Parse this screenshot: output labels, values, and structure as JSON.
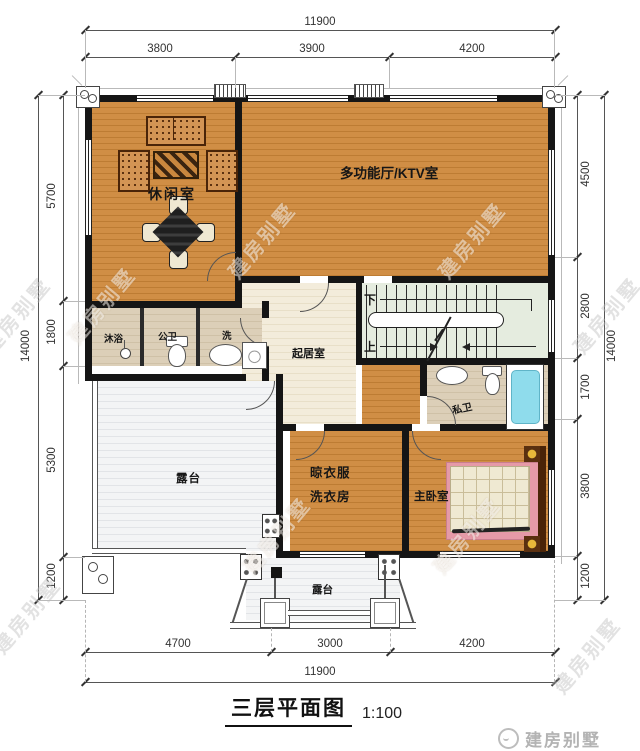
{
  "meta": {
    "title": "三层平面图",
    "scale": "1:100",
    "brand": "建房别墅",
    "watermark": "建房别墅"
  },
  "dims": {
    "top": {
      "total": "11900",
      "segments": [
        "3800",
        "3900",
        "4200"
      ]
    },
    "bottom": {
      "total": "11900",
      "segments": [
        "4700",
        "3000",
        "4200"
      ]
    },
    "left": {
      "total": "14000",
      "segments": [
        "5700",
        "1800",
        "5300",
        "1200"
      ]
    },
    "right": {
      "total": "14000",
      "segments": [
        "4500",
        "2800",
        "1700",
        "3800",
        "1200"
      ]
    }
  },
  "rooms": {
    "leisure": "休闲室",
    "ktv": "多功能厅/KTV室",
    "hall": "起居室",
    "shower": "沐浴",
    "public_wc": "公卫",
    "wash": "洗",
    "terrace_left": "露台",
    "laundry_line1": "晾衣服",
    "laundry_line2": "洗衣房",
    "private_wc": "私卫",
    "master_bedroom": "主卧室",
    "terrace_bottom": "露台"
  },
  "stairs": {
    "down": "下",
    "up": "上"
  },
  "colors": {
    "wood": "#c9883f",
    "wall": "#151515",
    "bath_floor": "#d9cbb3",
    "hall_floor": "#f1e9d6",
    "stair_floor": "#e5ecdf",
    "terrace_floor": "#eff0f1",
    "tub": "#8fdcec",
    "bed_blanket": "#e59aa8",
    "lamp": "#e8b83a"
  }
}
